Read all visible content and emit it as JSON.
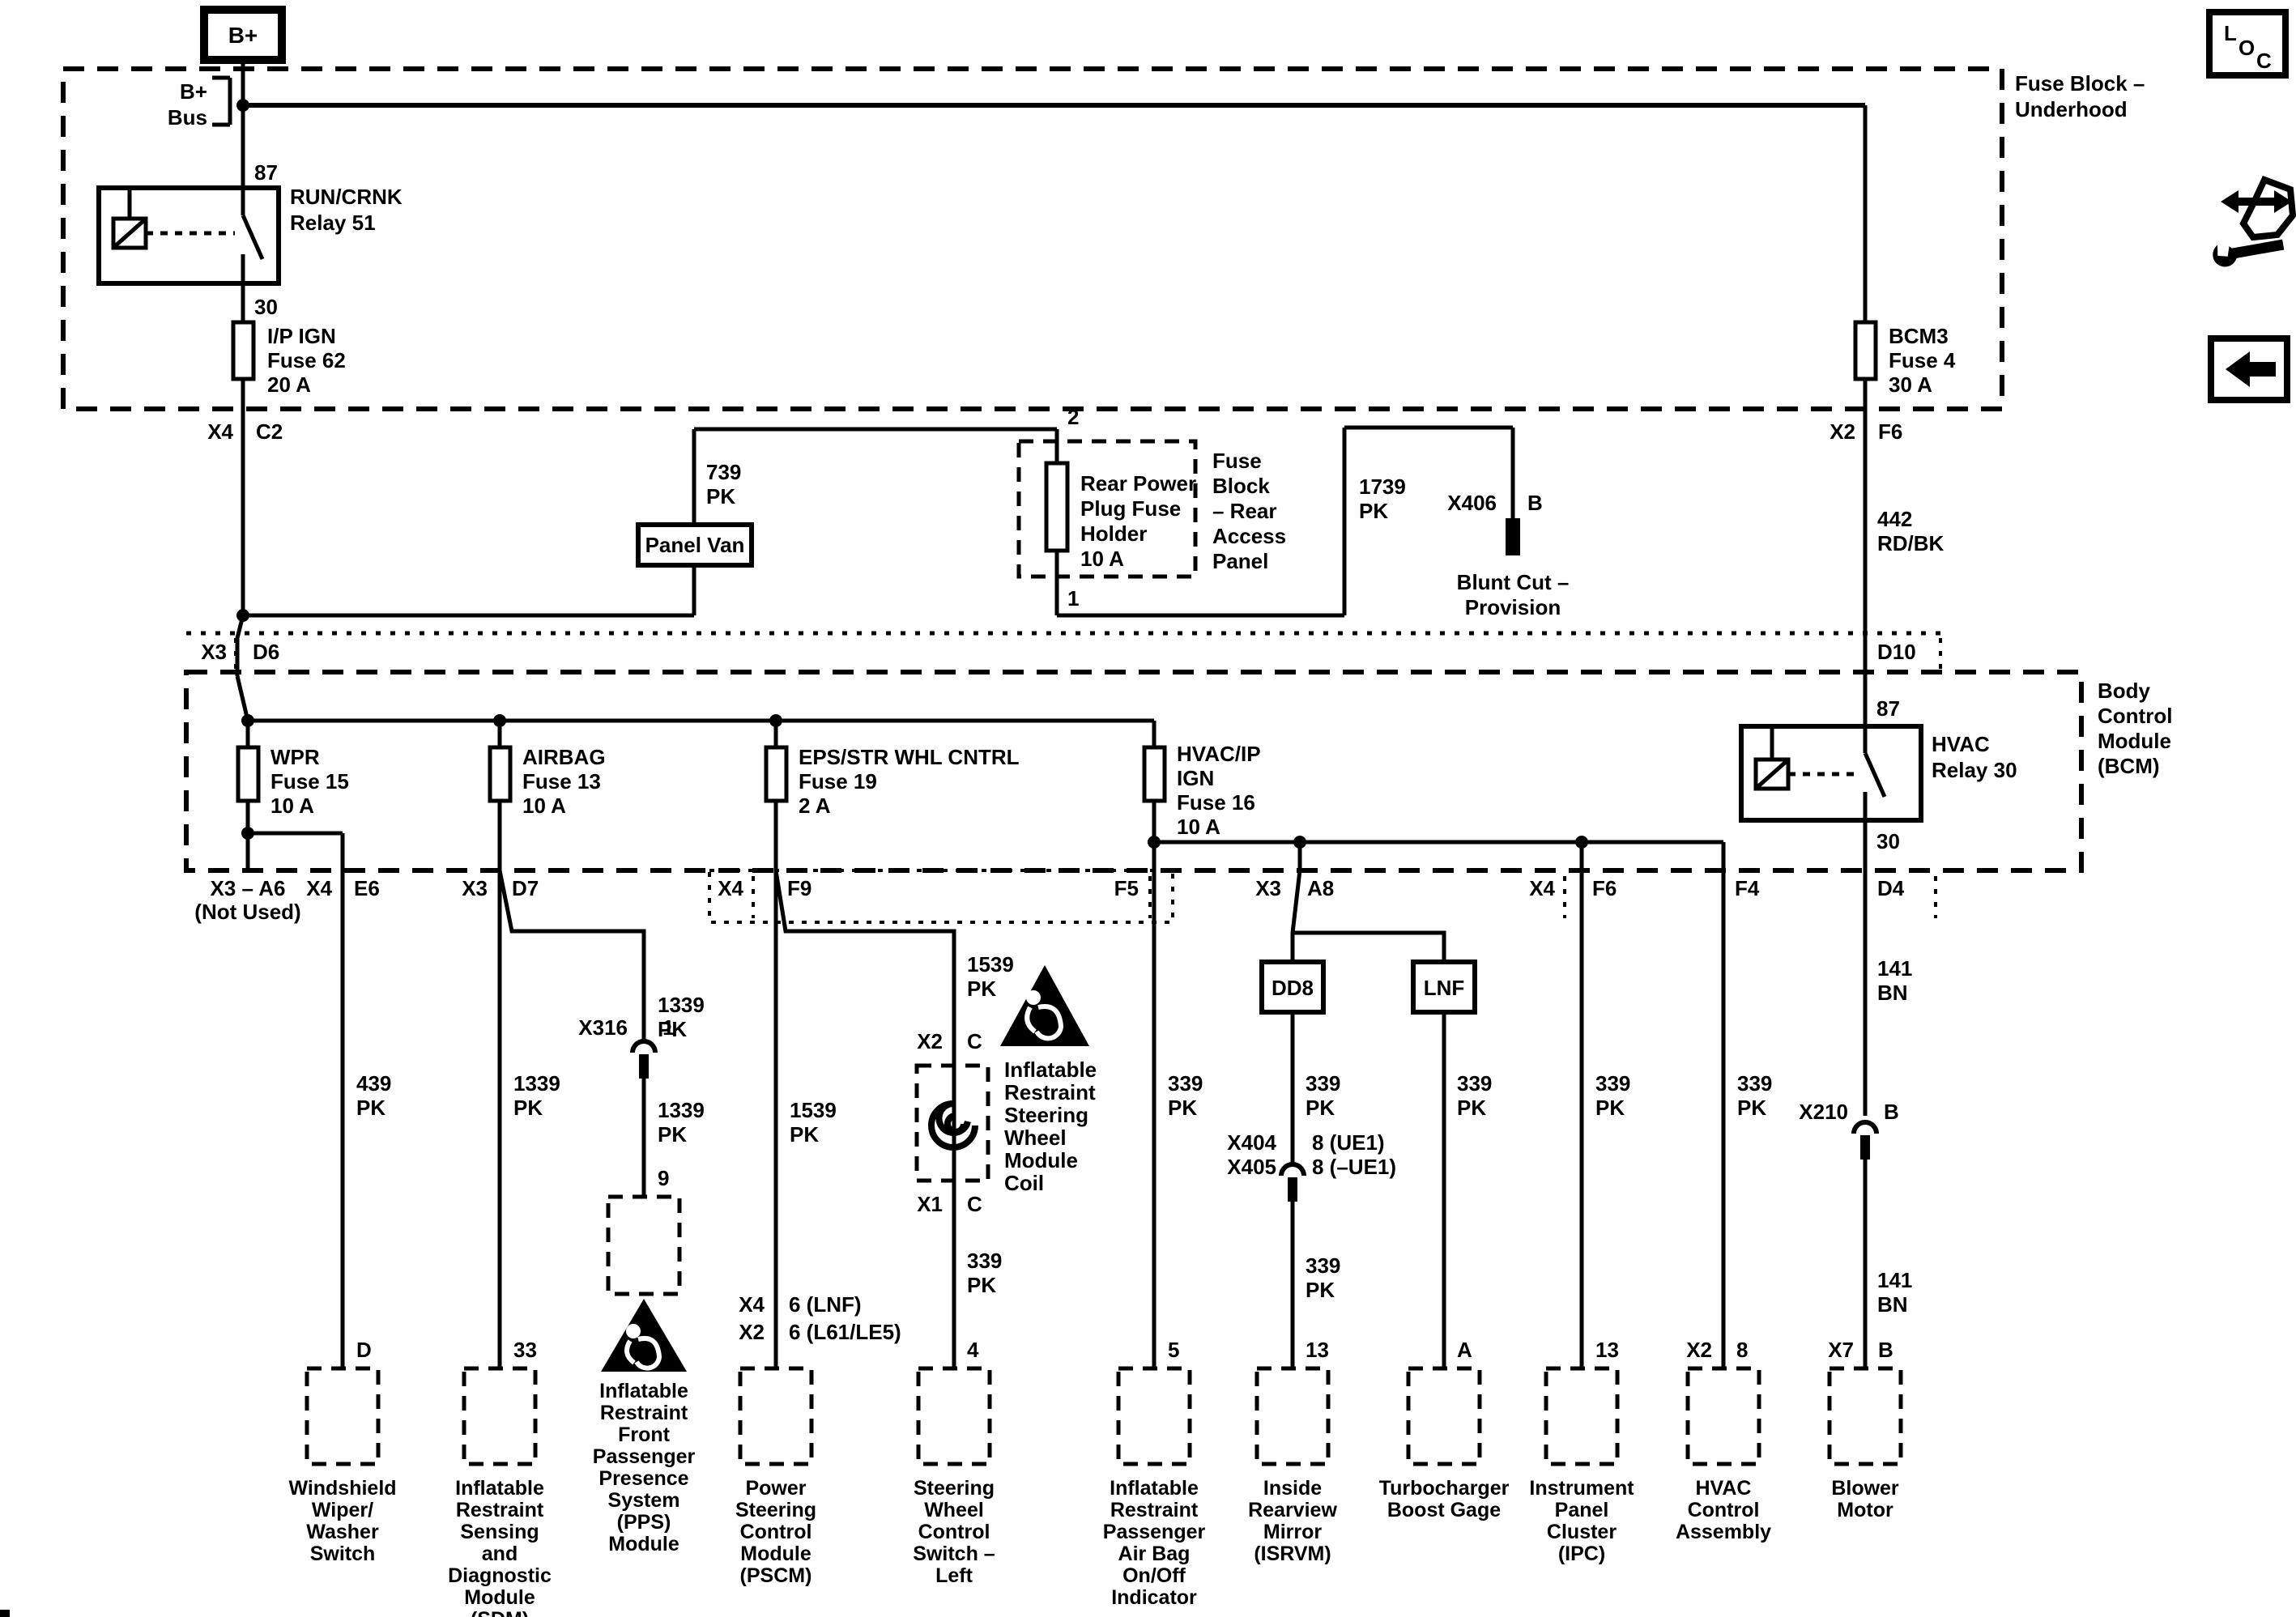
{
  "sidebar": {
    "loc_l": "L",
    "loc_o": "O",
    "loc_c": "C"
  },
  "top": {
    "bplus": "B+",
    "bplus_bus": "B+\nBus",
    "underhood_label": "Fuse Block –\nUnderhood",
    "relay51": {
      "t87": "87",
      "name": "RUN/CRNK\nRelay 51",
      "t30": "30"
    },
    "fuse62": "I/P IGN\nFuse 62\n20 A",
    "fuse4": "BCM3\nFuse 4\n30 A",
    "left_conn": "X4",
    "left_pin": "C2",
    "right_conn": "X2",
    "right_pin": "F6"
  },
  "middle": {
    "w739": "739\nPK",
    "panel_van": "Panel Van",
    "t2": "2",
    "t1": "1",
    "rear_holder": "Rear Power\nPlug Fuse\nHolder\n10 A",
    "rear_block": "Fuse\nBlock\n– Rear\nAccess\nPanel",
    "w1739": "1739\nPK",
    "x406": "X406",
    "x406_b": "B",
    "blunt": "Blunt Cut –\nProvision",
    "w442": "442\nRD/BK"
  },
  "x3row": {
    "x3": "X3",
    "d6": "D6",
    "d10": "D10"
  },
  "bcm": {
    "label": "Body\nControl\nModule\n(BCM)",
    "fuse15": "WPR\nFuse 15\n10 A",
    "fuse13": "AIRBAG\nFuse 13\n10 A",
    "fuse19": "EPS/STR WHL CNTRL\nFuse 19\n2 A",
    "fuse16": "HVAC/IP\nIGN\nFuse 16\n10 A",
    "relay30": {
      "t87": "87",
      "name": "HVAC\nRelay 30",
      "t30": "30"
    },
    "pins": {
      "a6": "X3 – A6\n(Not Used)",
      "e6_conn": "X4",
      "e6": "E6",
      "d7_conn": "X3",
      "d7": "D7",
      "f9_conn": "X4",
      "f9": "F9",
      "f5": "F5",
      "a8_conn": "X3",
      "a8": "A8",
      "f6_conn": "X4",
      "f6": "F6",
      "f4": "F4",
      "d4": "D4"
    }
  },
  "wires": {
    "w439": "439\nPK",
    "w1339": "1339\nPK",
    "w1539": "1539\nPK",
    "w339": "339\nPK",
    "w141": "141\nBN"
  },
  "inline": {
    "x316": "X316",
    "x316_pin": "1",
    "pps_pin": "9",
    "coil_top_conn": "X2",
    "coil_top_pin": "C",
    "coil_bot_conn": "X1",
    "coil_bot_pin": "C",
    "coil_label": "Inflatable\nRestraint\nSteering\nWheel\nModule\nCoil",
    "dd8": "DD8",
    "lnf": "LNF",
    "x404": "X404\nX405",
    "x404_pins": "8 (UE1)\n8 (–UE1)",
    "x210": "X210",
    "x210_pin": "B"
  },
  "modules": [
    {
      "pin": "D",
      "caption": "Windshield\nWiper/\nWasher\nSwitch"
    },
    {
      "pin": "33",
      "caption": "Inflatable\nRestraint\nSensing\nand\nDiagnostic\nModule\n(SDM)"
    },
    {
      "pin": "9",
      "caption": "Inflatable\nRestraint\nFront\nPassenger\nPresence\nSystem\n(PPS)\nModule"
    },
    {
      "t1_conn": "X4",
      "t1_pin": "6 (LNF)",
      "t2_conn": "X2",
      "t2_pin": "6 (L61/LE5)",
      "caption": "Power\nSteering\nControl\nModule\n(PSCM)"
    },
    {
      "pin": "4",
      "caption": "Steering\nWheel\nControl\nSwitch –\nLeft"
    },
    {
      "pin": "5",
      "caption": "Inflatable\nRestraint\nPassenger\nAir Bag\nOn/Off\nIndicator"
    },
    {
      "pin": "13",
      "caption": "Inside\nRearview\nMirror\n(ISRVM)"
    },
    {
      "pin": "A",
      "caption": "Turbocharger\nBoost Gage"
    },
    {
      "pin": "13",
      "caption": "Instrument\nPanel\nCluster\n(IPC)"
    },
    {
      "conn": "X2",
      "pin": "8",
      "caption": "HVAC\nControl\nAssembly"
    },
    {
      "conn": "X7",
      "pin": "B",
      "caption": "Blower\nMotor"
    }
  ]
}
